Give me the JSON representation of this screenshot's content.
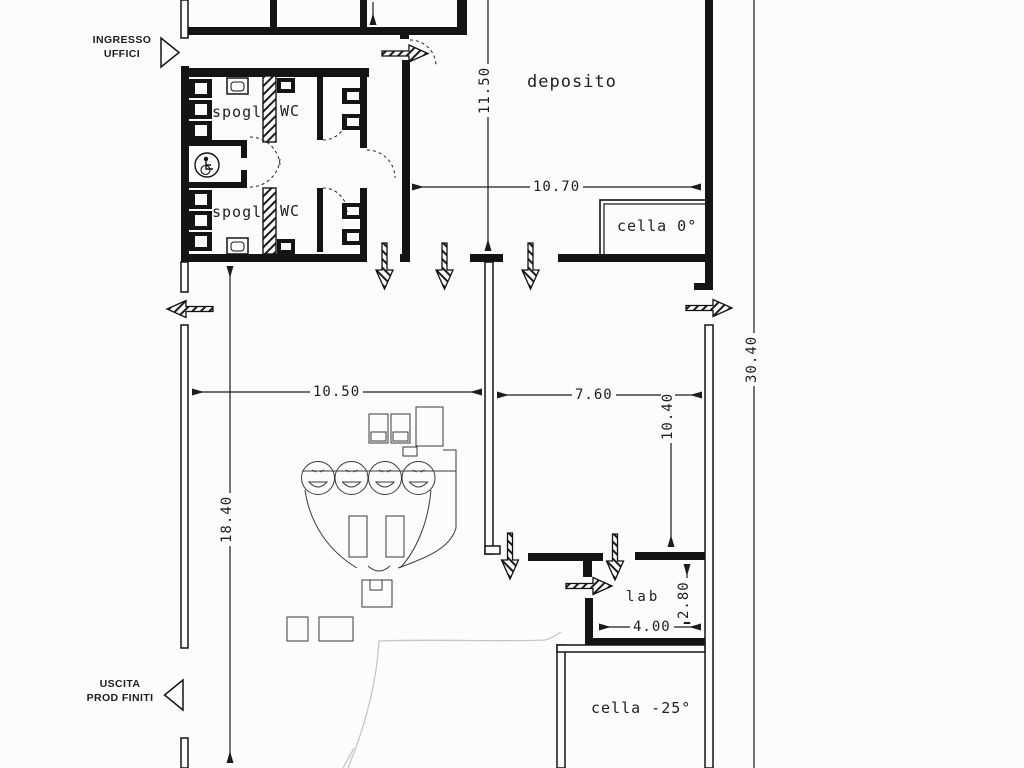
{
  "entrances": {
    "ingresso_line1": "INGRESSO",
    "ingresso_line2": "UFFICI",
    "uscita_line1": "USCITA",
    "uscita_line2": "PROD FINITI"
  },
  "rooms": {
    "deposito": "deposito",
    "cella_zero": "cella 0°",
    "spogliatoio_top": "spogl",
    "wc_top": "WC",
    "spogliatoio_bottom": "spogl",
    "wc_bottom": "WC",
    "lab": "lab",
    "cella_freezer": "cella -25°"
  },
  "dimensions": {
    "v11_50": "11.50",
    "h10_70": "10.70",
    "v30_40": "30.40",
    "h10_50": "10.50",
    "h7_60": "7.60",
    "v10_40": "10.40",
    "v18_40": "18.40",
    "v2_80": "2.80",
    "h4_00": "4.00"
  },
  "icons": {
    "wheelchair": "wheelchair-accessible-icon",
    "flow_arrow": "direction-arrow-icon",
    "door_marker": "door-triangle-icon"
  },
  "colors": {
    "ink": "#1c1c1c",
    "paper": "#fcfcfc",
    "pencil": "#c6c6c6"
  }
}
